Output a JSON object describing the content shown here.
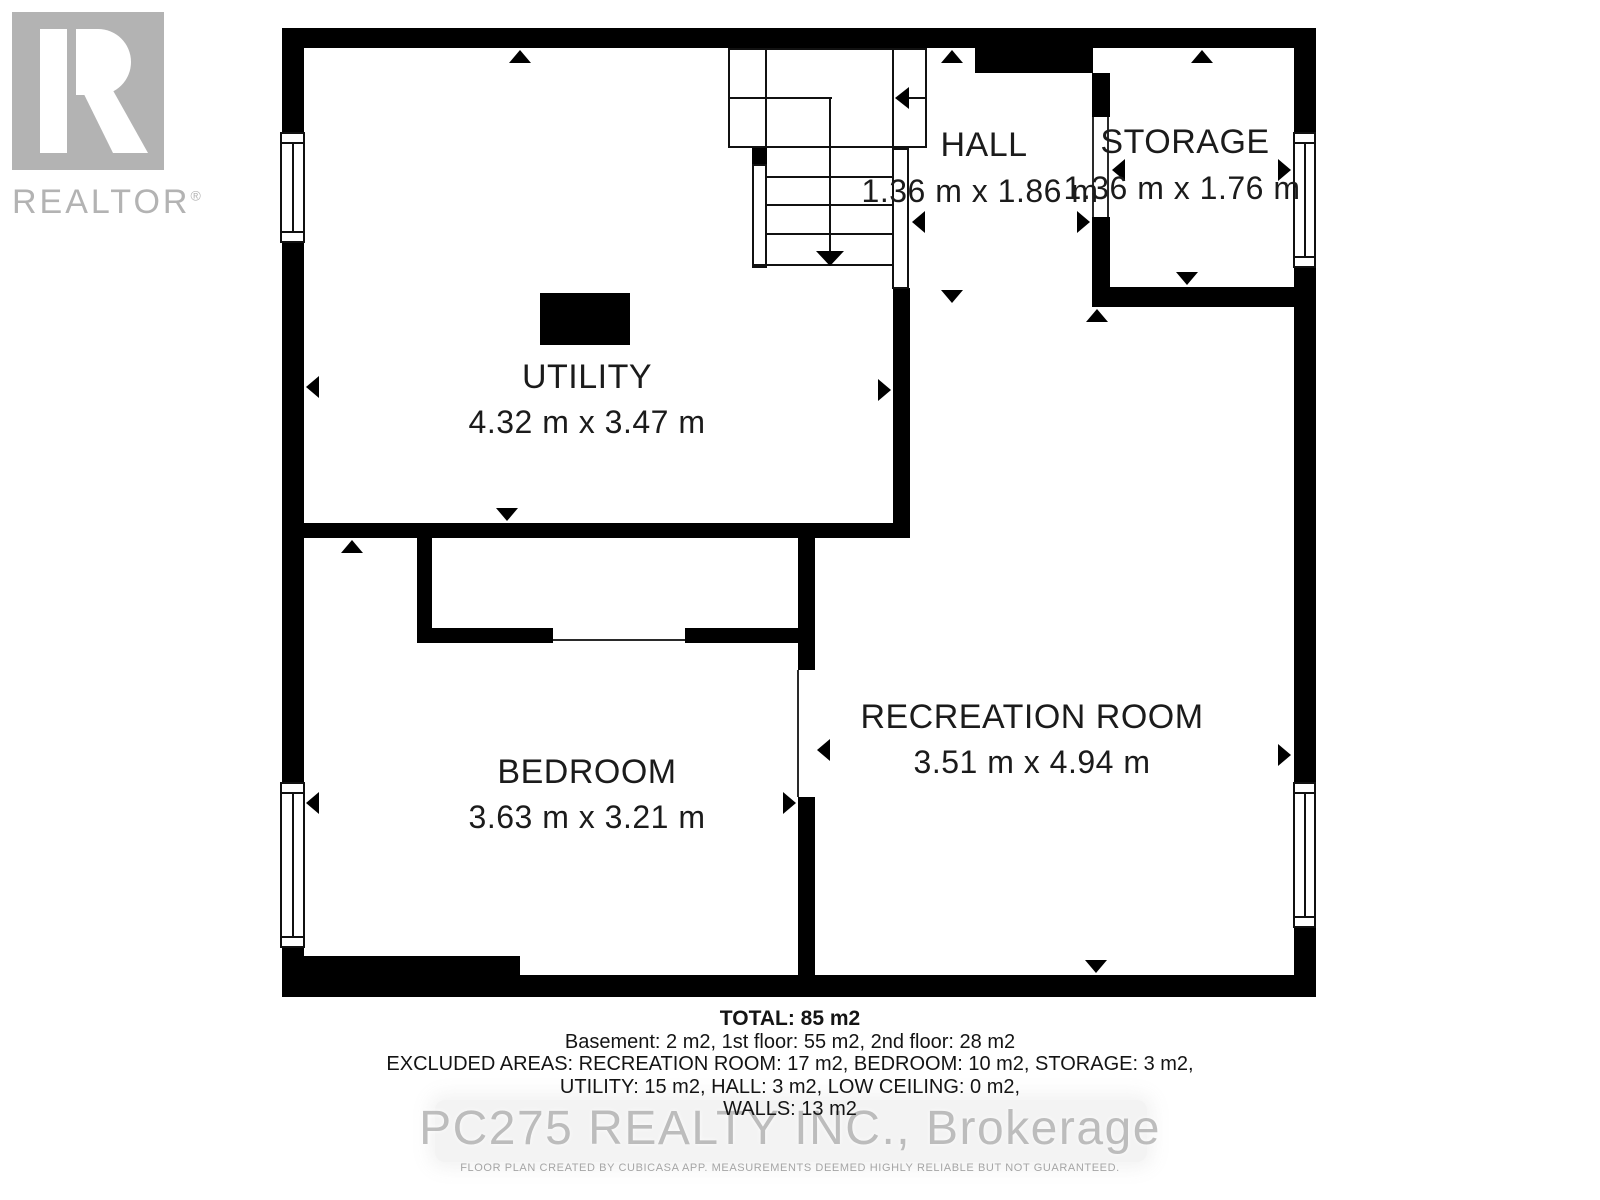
{
  "branding": {
    "logo_label": "REALTOR",
    "registered_mark": "®",
    "logo_color": "#b3b3b3"
  },
  "rooms": {
    "utility": {
      "label": "UTILITY",
      "dims": "4.32 m x 3.47 m"
    },
    "hall": {
      "label": "HALL",
      "dims": "1.36 m x 1.86 m"
    },
    "storage": {
      "label": "STORAGE",
      "dims": "1.36 m x 1.76 m"
    },
    "bedroom": {
      "label": "BEDROOM",
      "dims": "3.63 m x 3.21 m"
    },
    "recreation": {
      "label": "RECREATION ROOM",
      "dims": "3.51 m x 4.94 m"
    }
  },
  "summary": {
    "total": "TOTAL: 85 m2",
    "line1": "Basement: 2 m2, 1st floor: 55 m2, 2nd floor: 28 m2",
    "line2": "EXCLUDED AREAS: RECREATION ROOM: 17 m2, BEDROOM: 10 m2, STORAGE: 3 m2,",
    "line3": "UTILITY: 15 m2, HALL: 3 m2, LOW CEILING: 0 m2,",
    "line4": "WALLS: 13 m2"
  },
  "watermark": "PC275 REALTY INC., Brokerage",
  "disclaimer": "FLOOR PLAN CREATED BY CUBICASA APP. MEASUREMENTS DEEMED HIGHLY RELIABLE BUT NOT GUARANTEED.",
  "colors": {
    "wall": "#000000",
    "text": "#1b1b1b",
    "watermark": "#b2b2b2",
    "logo": "#b3b3b3"
  }
}
